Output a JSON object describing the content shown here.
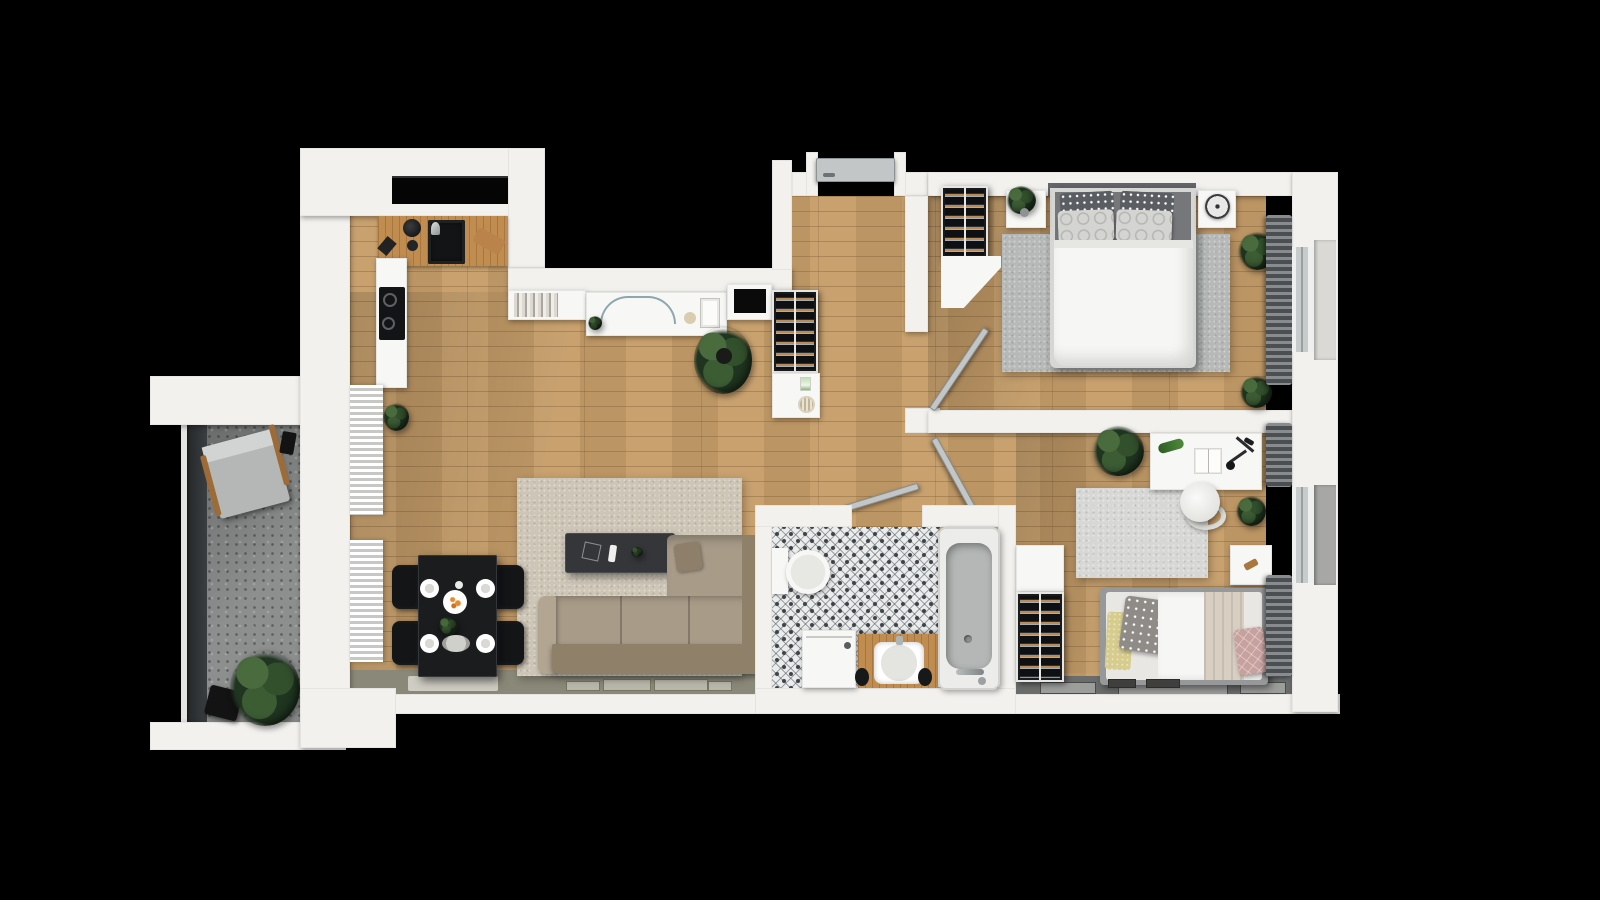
{
  "meta": {
    "title": "Two-bedroom apartment — photorealistic 3D top-down floor plan render",
    "view": "top-down 3D render on black background",
    "canvas_px": {
      "width": 1600,
      "height": 900
    }
  },
  "palette": {
    "bg": "#000000",
    "wall": "#f2f1ee",
    "woodFloor": "#c59d69",
    "counterWood": "#c08c4f",
    "blackFixture": "#131416",
    "concrete": "#8c8f8e",
    "railingGlass": "#25282a",
    "tileBase": "#ebecec",
    "tileInk": "#3e4348",
    "sillOlive": "#8a8878",
    "sillDark": "#6b6d6c",
    "sillFrameLight": "#cfcdc3",
    "sillFrameDark": "#9c9e9c",
    "rugLiving": "#cdc5b6",
    "rugBedroom": "#b6b9b8",
    "rugOffice": "#d7d7d5",
    "sofaBody": "#a89b88",
    "sofaBack": "#8f8169",
    "sofaArm": "#b2a592",
    "tableBlack": "#1b1c1e",
    "chairBlack": "#141517",
    "coffeeTable": "#35363a",
    "duvetWhite": "#f6f6f4",
    "mattressDark": "#75777a",
    "pillowDot": "#5a5d61",
    "pillowRing": "#d4d4d2",
    "pillowYellow": "#d6cc8e",
    "pillowPink": "#c7a19d",
    "blanketBeige": "#d8cec2",
    "bedFrameGray": "#96989a",
    "rackFrame": "#e6e6e3",
    "rackDark": "#191a1d",
    "bottleAmber": "#b98b57",
    "bottleSteel": "#a8adb2",
    "radiatorDark": "#4c4f51",
    "doorLeaf": "#c3c6c6",
    "plantDark": "#1f3520",
    "plantLight": "#4a6b3d",
    "potBlack": "#131313",
    "woodArm": "#9c6b38",
    "tubInner": "#b4b7b6",
    "fixtureWhite": "#f7f7f5",
    "headboard": "#63666a"
  },
  "rooms": {
    "balcony": {
      "label": "Balcony",
      "floor": "concrete",
      "items": [
        "glass railing",
        "lounge chair",
        "potted plant",
        "planter pot",
        "portable speaker"
      ]
    },
    "kitchen": {
      "label": "Kitchen",
      "floor": "wood",
      "items": [
        "L-shaped wood counter",
        "black sink with faucet",
        "coffee grinder",
        "cutting board",
        "induction cooktop (2 burners)",
        "window"
      ]
    },
    "living_room": {
      "label": "Living / Dining Room",
      "floor": "wood",
      "items": [
        "bookshelf with books",
        "white sideboard with glass arc sculpture",
        "wall TV niche",
        "wine rack with cabinet",
        "large floor plant",
        "beige rug",
        "dark coffee table with candle and frame",
        "L-shaped corner sofa with chaise",
        "black dining table",
        "4 black dining chairs",
        "4 place settings",
        "2 white wall radiators",
        "small plant by radiator",
        "window sill with frames"
      ]
    },
    "hallway": {
      "label": "Hallway",
      "floor": "wood",
      "items": [
        "entrance door",
        "storage rack",
        "cabinet with poster and basket"
      ]
    },
    "bedroom": {
      "label": "Bedroom",
      "floor": "wood",
      "items": [
        "double bed with white duvet",
        "2 polka-dot pillows",
        "2 ring-pattern pillows",
        "dark headboard",
        "2 nightstands",
        "table fan",
        "plant on nightstand",
        "gray rug",
        "wardrobe bottle rack",
        "white corner cabinet",
        "2 floor plants",
        "dark radiator",
        "window with sill",
        "interior door"
      ]
    },
    "bathroom": {
      "label": "Bathroom",
      "floor": "patterned tile",
      "items": [
        "toilet",
        "washing machine",
        "wood vanity with white sink",
        "2 dark stools",
        "bathtub with chrome faucet",
        "interior door"
      ]
    },
    "second_bedroom": {
      "label": "Second Bedroom / Office",
      "floor": "wood",
      "items": [
        "white desk",
        "desk lamp",
        "open book",
        "toy lizard",
        "round office chair",
        "light rug",
        "large plant",
        "small plant",
        "nightstand",
        "single bed with yellow, dotted and pink pillows",
        "beige blanket",
        "closet cabinet with bottle rack",
        "2 dark radiators",
        "window with sill",
        "2 floor mats",
        "interior door"
      ]
    }
  },
  "counts": {
    "windows": 3,
    "interior_doors": 3,
    "entrance_doors": 1,
    "radiators_white": 2,
    "radiators_dark": 3,
    "storage_racks": 3,
    "dining_chairs": 4,
    "place_settings": 4
  }
}
